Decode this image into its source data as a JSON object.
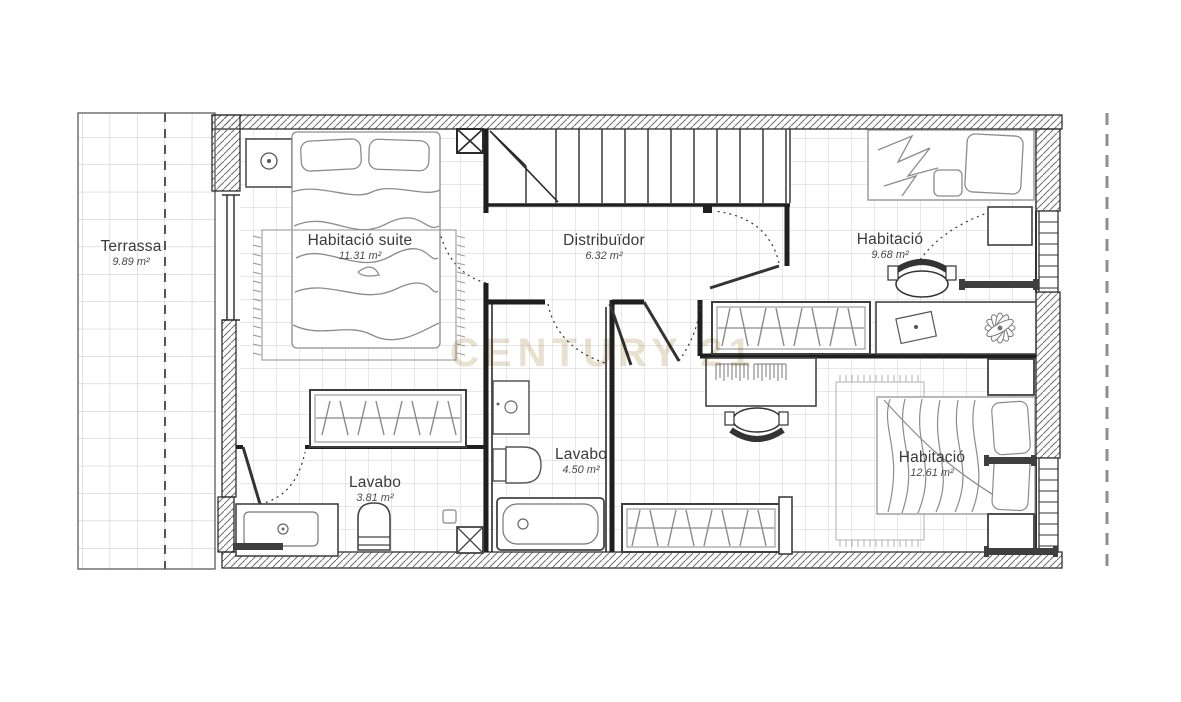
{
  "watermark": "CENTURY 21",
  "rooms": [
    {
      "name": "Terrassa",
      "area": "9.89 m²"
    },
    {
      "name": "Habitació suite",
      "area": "11.31 m²"
    },
    {
      "name": "Distribuïdor",
      "area": "6.32 m²"
    },
    {
      "name": "Habitació",
      "area": "9.68 m²"
    },
    {
      "name": "Lavabo",
      "area": "3.81 m²"
    },
    {
      "name": "Lavabo",
      "area": "4.50 m²"
    },
    {
      "name": "Habitació",
      "area": "12.61 m²"
    }
  ],
  "colors": {
    "walls": "#1f1f1f",
    "floor_grid": "#d2d2d2",
    "furniture_lines": "#8c8c8c",
    "watermark": "#e9e1d0",
    "boundary_dash": "#8f8f8f"
  }
}
